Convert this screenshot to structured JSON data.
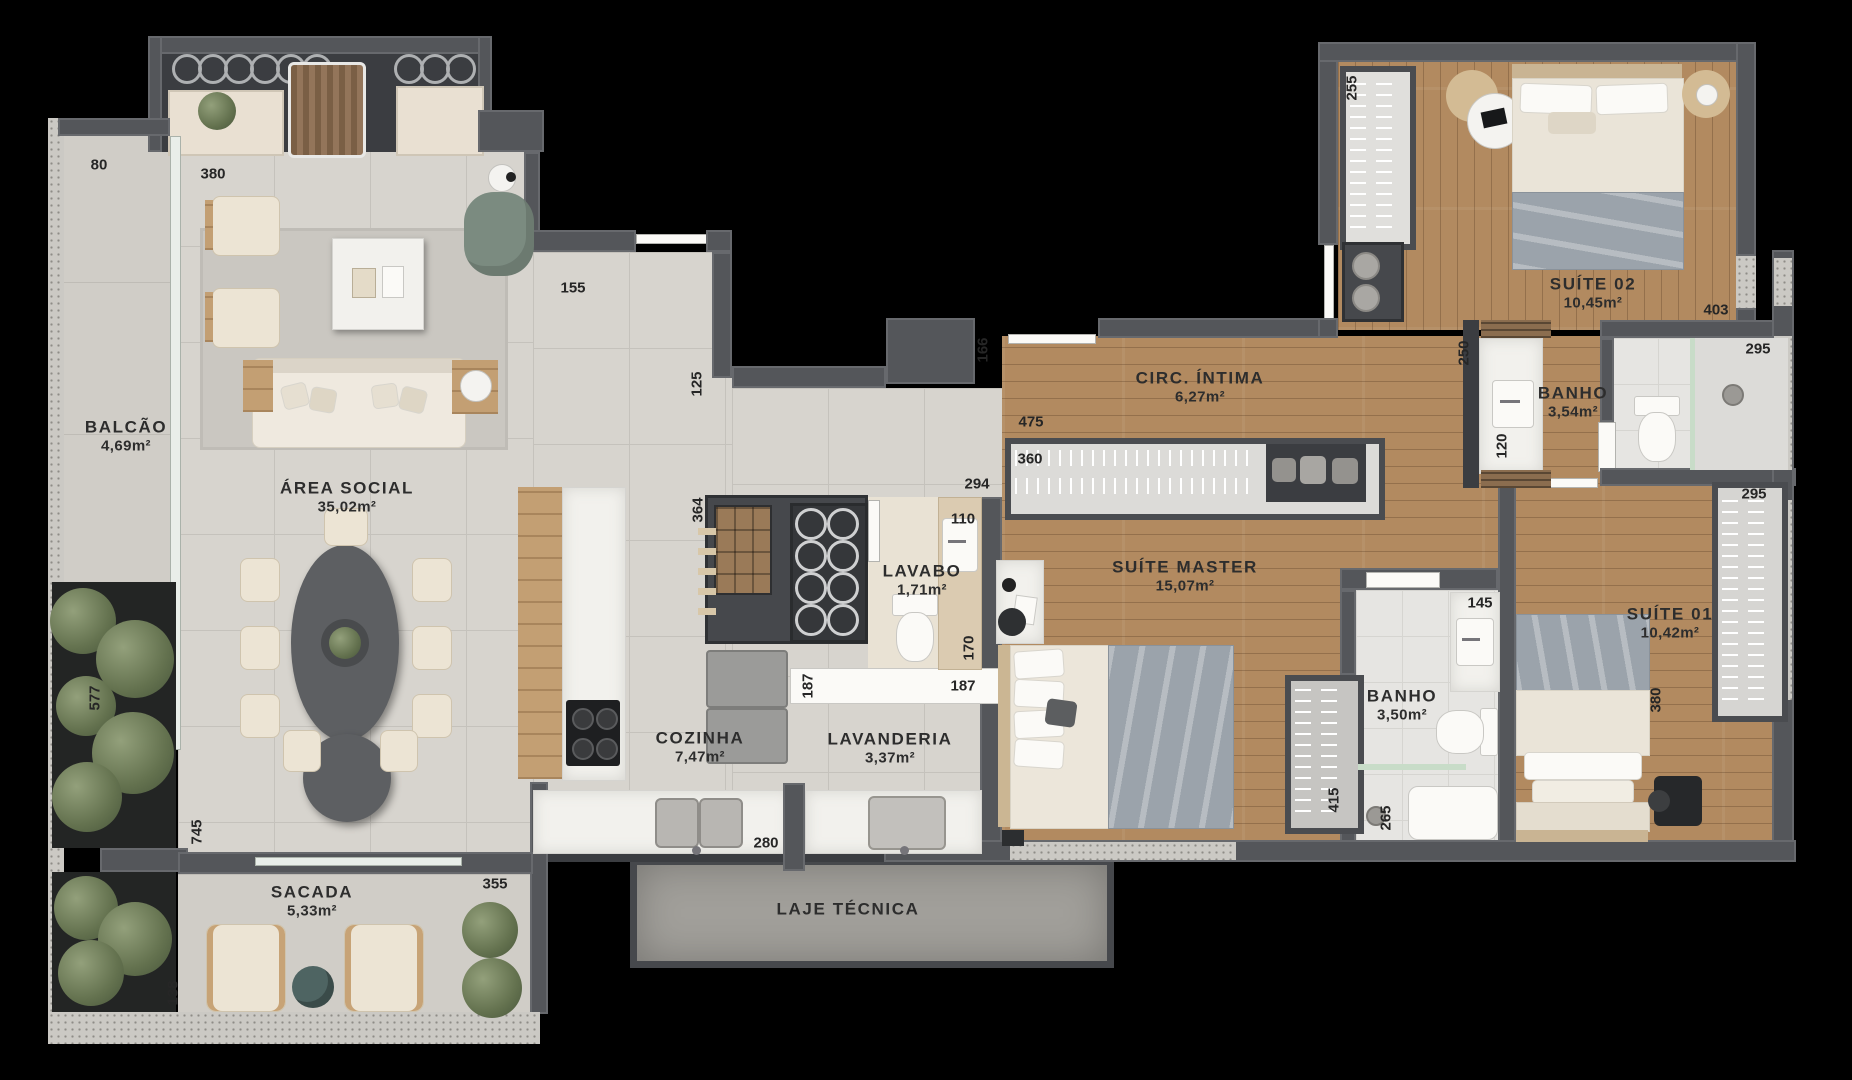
{
  "colors": {
    "background": "#000000",
    "wall": "#54565a",
    "tile_floor": "#d7d4ce",
    "wood_floor": "#b28a60",
    "bath_floor": "#e6e5e2",
    "concrete": "#a19f9a",
    "marble": "#f2f1ed",
    "label_text": "#2d2d2d",
    "plant_green": "#64724f",
    "blanket_gray": "#9ba3ab"
  },
  "rooms": [
    {
      "name": "BALCÃO",
      "area": "4,69m²"
    },
    {
      "name": "ÁREA SOCIAL",
      "area": "35,02m²"
    },
    {
      "name": "SACADA",
      "area": "5,33m²"
    },
    {
      "name": "COZINHA",
      "area": "7,47m²"
    },
    {
      "name": "LAVANDERIA",
      "area": "3,37m²"
    },
    {
      "name": "LAVABO",
      "area": "1,71m²"
    },
    {
      "name": "LAJE TÉCNICA",
      "area": ""
    },
    {
      "name": "CIRC. ÍNTIMA",
      "area": "6,27m²"
    },
    {
      "name": "SUÍTE MASTER",
      "area": "15,07m²"
    },
    {
      "name": "SUÍTE 02",
      "area": "10,45m²"
    },
    {
      "name": "BANHO",
      "area": "3,54m²"
    },
    {
      "name": "SUÍTE 01",
      "area": "10,42m²"
    },
    {
      "name": "BANHO",
      "area": "3,50m²"
    }
  ],
  "dimensions": [
    {
      "value": "80"
    },
    {
      "value": "380"
    },
    {
      "value": "155"
    },
    {
      "value": "125"
    },
    {
      "value": "166"
    },
    {
      "value": "475"
    },
    {
      "value": "360"
    },
    {
      "value": "294"
    },
    {
      "value": "110"
    },
    {
      "value": "364"
    },
    {
      "value": "170"
    },
    {
      "value": "187"
    },
    {
      "value": "187"
    },
    {
      "value": "280"
    },
    {
      "value": "355"
    },
    {
      "value": "577"
    },
    {
      "value": "745"
    },
    {
      "value": "138"
    },
    {
      "value": "255"
    },
    {
      "value": "250"
    },
    {
      "value": "120"
    },
    {
      "value": "403"
    },
    {
      "value": "295"
    },
    {
      "value": "295"
    },
    {
      "value": "145"
    },
    {
      "value": "415"
    },
    {
      "value": "265"
    },
    {
      "value": "380"
    }
  ]
}
